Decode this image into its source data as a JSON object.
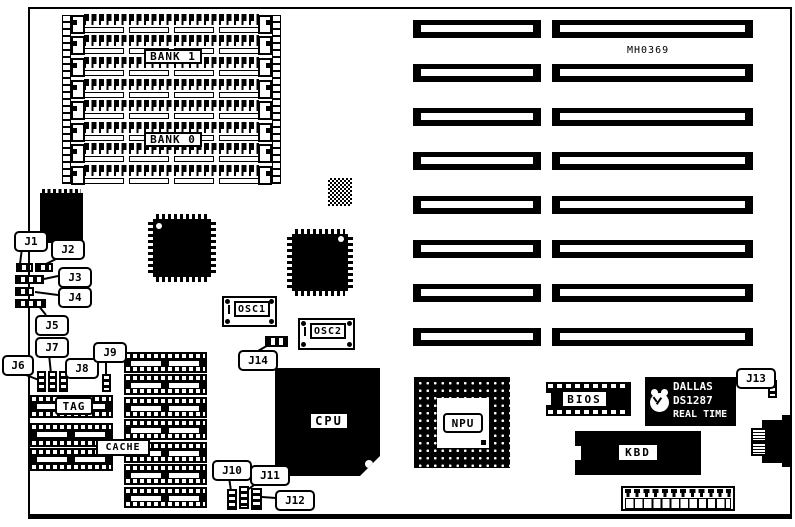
{
  "board": {
    "part_number": "MH0369"
  },
  "colors": {
    "ink": "#000000",
    "paper": "#ffffff"
  },
  "memory": {
    "bank1": "BANK 1",
    "bank0": "BANK 0"
  },
  "components": {
    "cpu": "CPU",
    "npu": "NPU",
    "bios": "BIOS",
    "kbd": "KBD",
    "tag": "TAG",
    "cache": "CACHE",
    "osc1": "OSC1",
    "osc2": "OSC2"
  },
  "rtc": {
    "brand": "DALLAS",
    "model": "DS1287",
    "type": "REAL TIME"
  },
  "jumpers": {
    "j1": "J1",
    "j2": "J2",
    "j3": "J3",
    "j4": "J4",
    "j5": "J5",
    "j6": "J6",
    "j7": "J7",
    "j8": "J8",
    "j9": "J9",
    "j10": "J10",
    "j11": "J11",
    "j12": "J12",
    "j13": "J13",
    "j14": "J14"
  }
}
